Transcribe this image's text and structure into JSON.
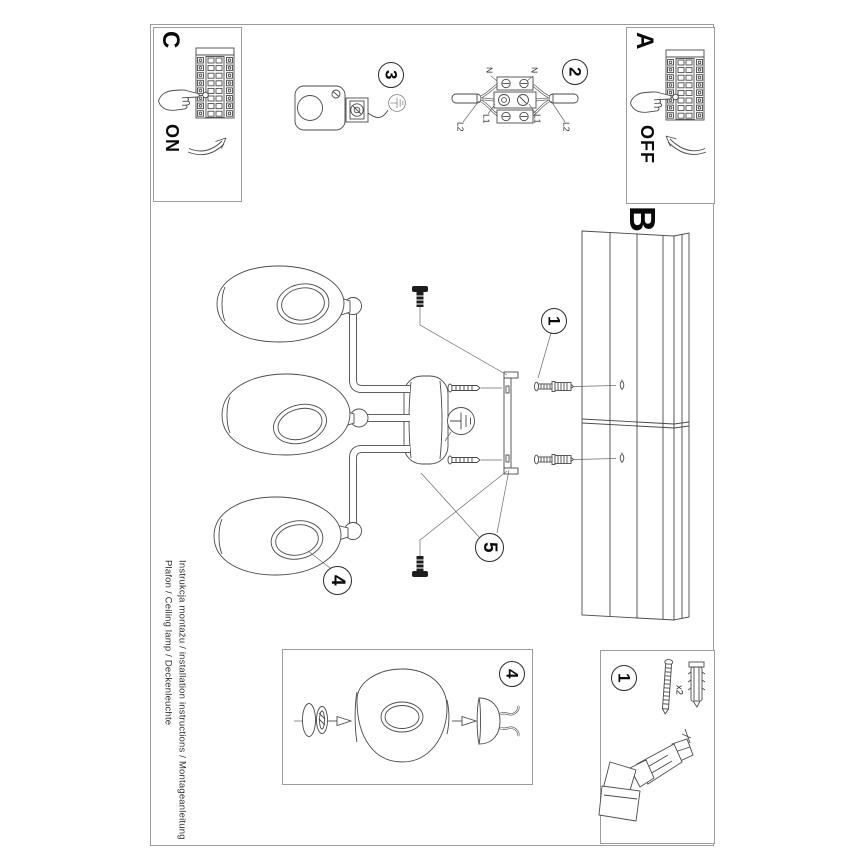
{
  "sections": {
    "a": {
      "label": "A",
      "power": "OFF"
    },
    "b": {
      "label": "B"
    },
    "c": {
      "label": "C",
      "power": "ON"
    }
  },
  "steps": {
    "s1": "1",
    "s2": "2",
    "s3": "3",
    "s4": "4",
    "s5": "5"
  },
  "hardware": {
    "qty": "x2"
  },
  "wiring": {
    "n": "N",
    "l1": "L1",
    "l2": "L2"
  },
  "footer": {
    "title": "Plafon / Ceiling lamp / Deckenleuchte",
    "instructions": "Instrukcja montażu / installation instructions / Montageanleitung"
  },
  "icons": {
    "breaker_panel": "circuit-breaker-panel-icon",
    "pressing_hand": "hand-press-icon",
    "ground": "earth-ground-icon",
    "drill": "power-drill-icon",
    "screw_plug": "screw-and-wall-plug-icon"
  },
  "colors": {
    "line": "#4a4a4a",
    "border": "#9c9c9c",
    "text": "#111111",
    "screw_black": "#1d1d1d"
  }
}
